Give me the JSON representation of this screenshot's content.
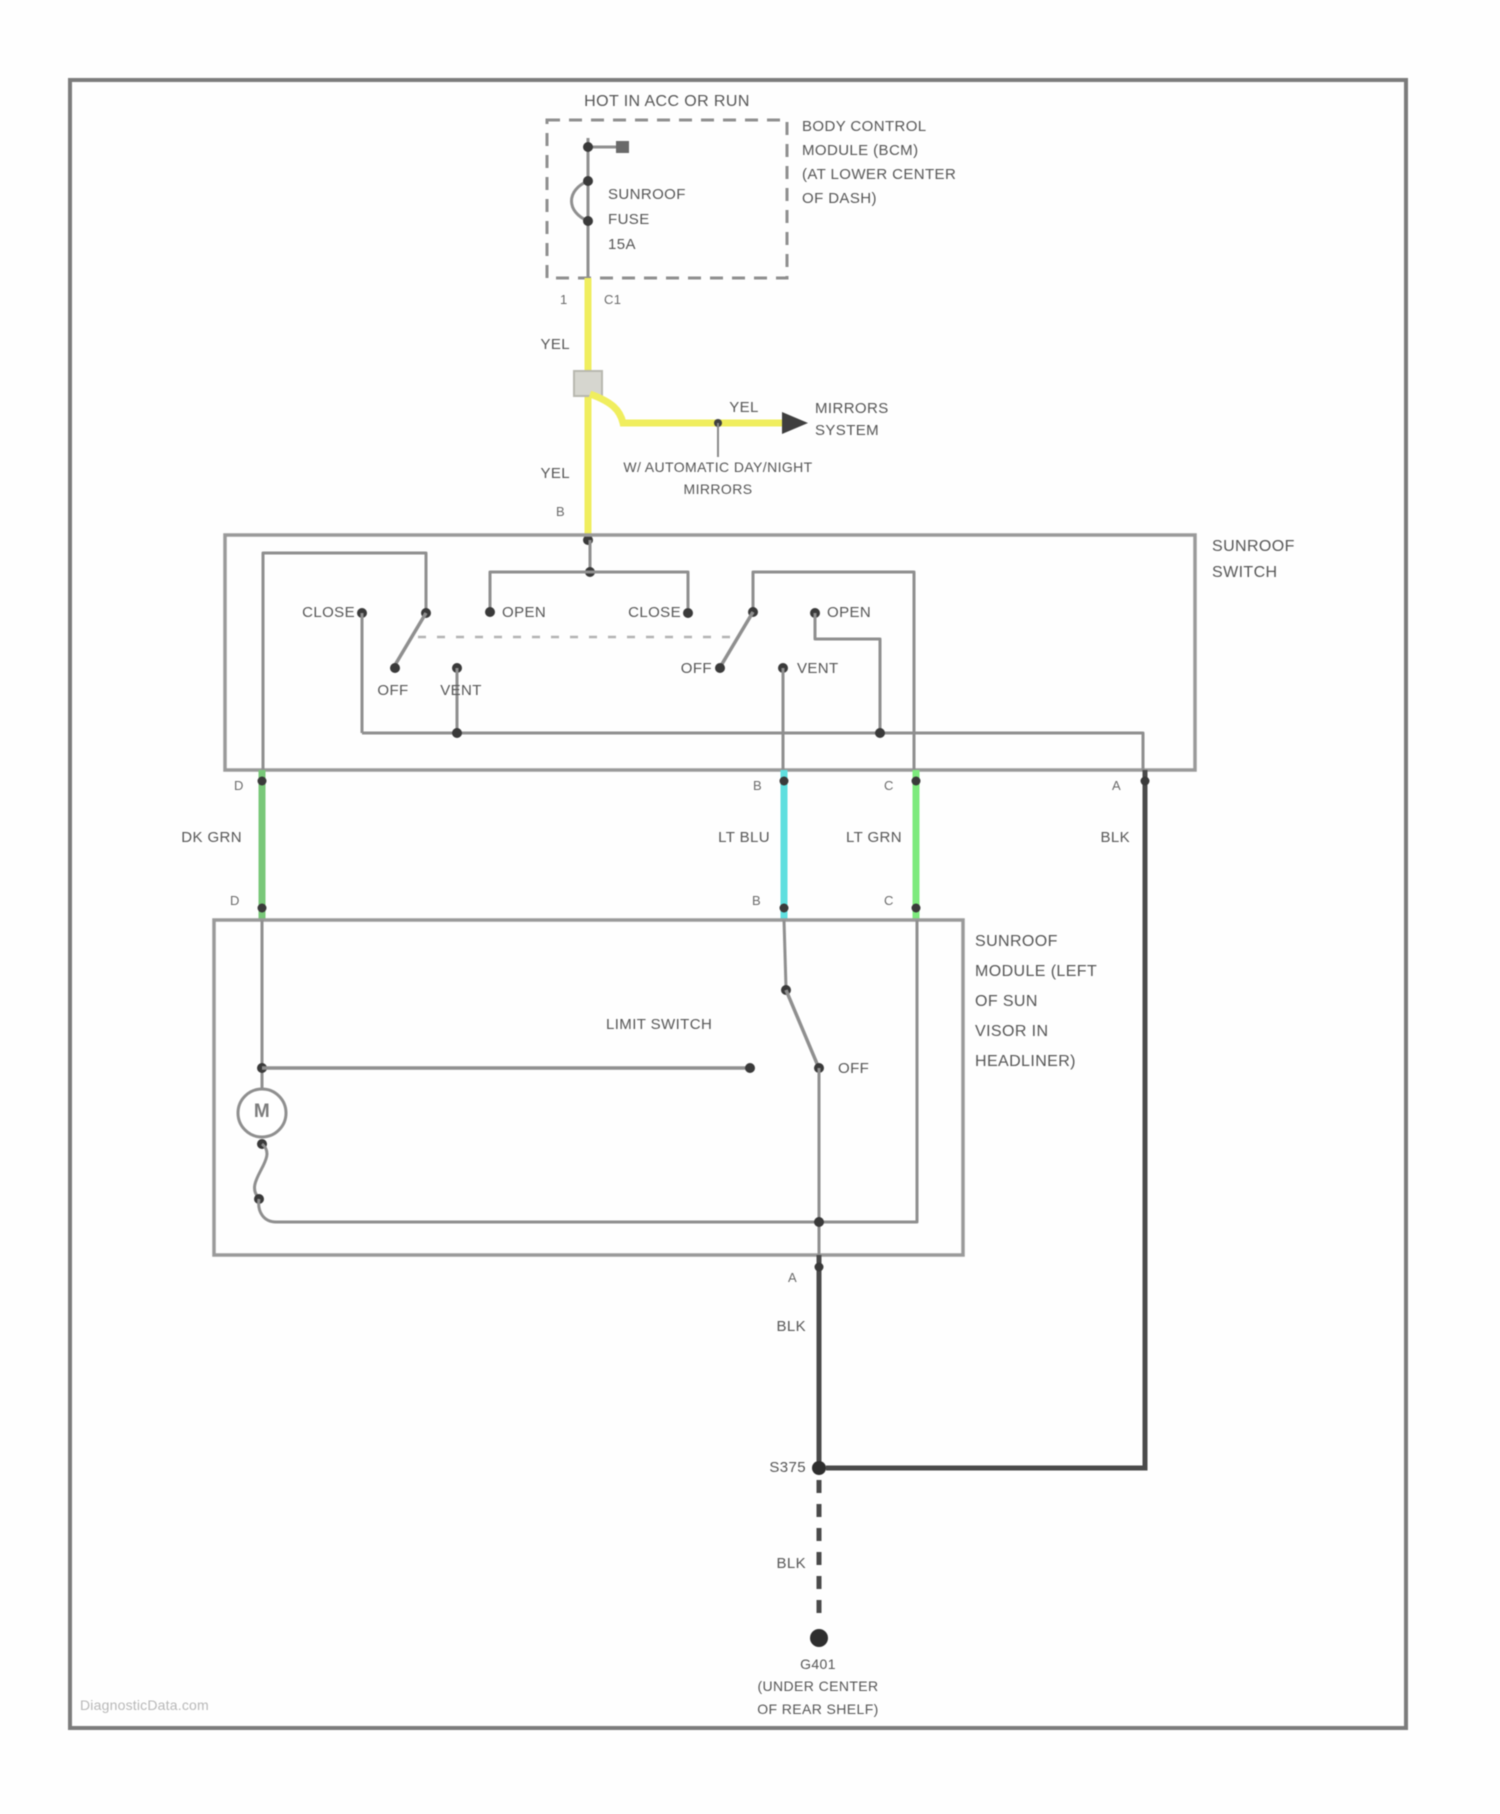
{
  "page": {
    "watermark": "DiagnosticData.com"
  },
  "colors": {
    "yel": "#f0ee5e",
    "dk_grn": "#79c879",
    "lt_blu": "#5fdfdf",
    "lt_grn": "#7dea7d",
    "blk": "#4a4a4a"
  },
  "power": {
    "label": "HOT IN ACC OR RUN"
  },
  "fuse": {
    "lines": [
      "SUNROOF",
      "FUSE",
      "15A"
    ]
  },
  "bcm": {
    "lines": [
      "BODY CONTROL",
      "MODULE (BCM)",
      "(AT LOWER CENTER",
      "OF DASH)"
    ],
    "pin": "1",
    "connector": "C1"
  },
  "wire_labels": {
    "yel": "YEL",
    "dk_grn": "DK GRN",
    "lt_blu": "LT BLU",
    "lt_grn": "LT GRN",
    "blk": "BLK"
  },
  "mirrors": {
    "lines": [
      "MIRRORS",
      "SYSTEM"
    ],
    "note": [
      "W/ AUTOMATIC DAY/NIGHT",
      "MIRRORS"
    ]
  },
  "sunroof_switch": {
    "label": [
      "SUNROOF",
      "SWITCH"
    ],
    "pin_in": "B",
    "close": "CLOSE",
    "open": "OPEN",
    "off": "OFF",
    "vent": "VENT",
    "pins": {
      "d": "D",
      "b": "B",
      "c": "C",
      "a": "A"
    }
  },
  "sunroof_module": {
    "label": [
      "SUNROOF",
      "MODULE (LEFT",
      "OF SUN",
      "VISOR IN",
      "HEADLINER)"
    ],
    "limit_switch": "LIMIT SWITCH",
    "off": "OFF",
    "motor": "M",
    "pins_top": [
      "D",
      "B",
      "C"
    ],
    "pin_bottom": "A"
  },
  "splice": {
    "label": "S375"
  },
  "ground": {
    "lines": [
      "G401",
      "(UNDER CENTER",
      "OF REAR SHELF)"
    ]
  }
}
